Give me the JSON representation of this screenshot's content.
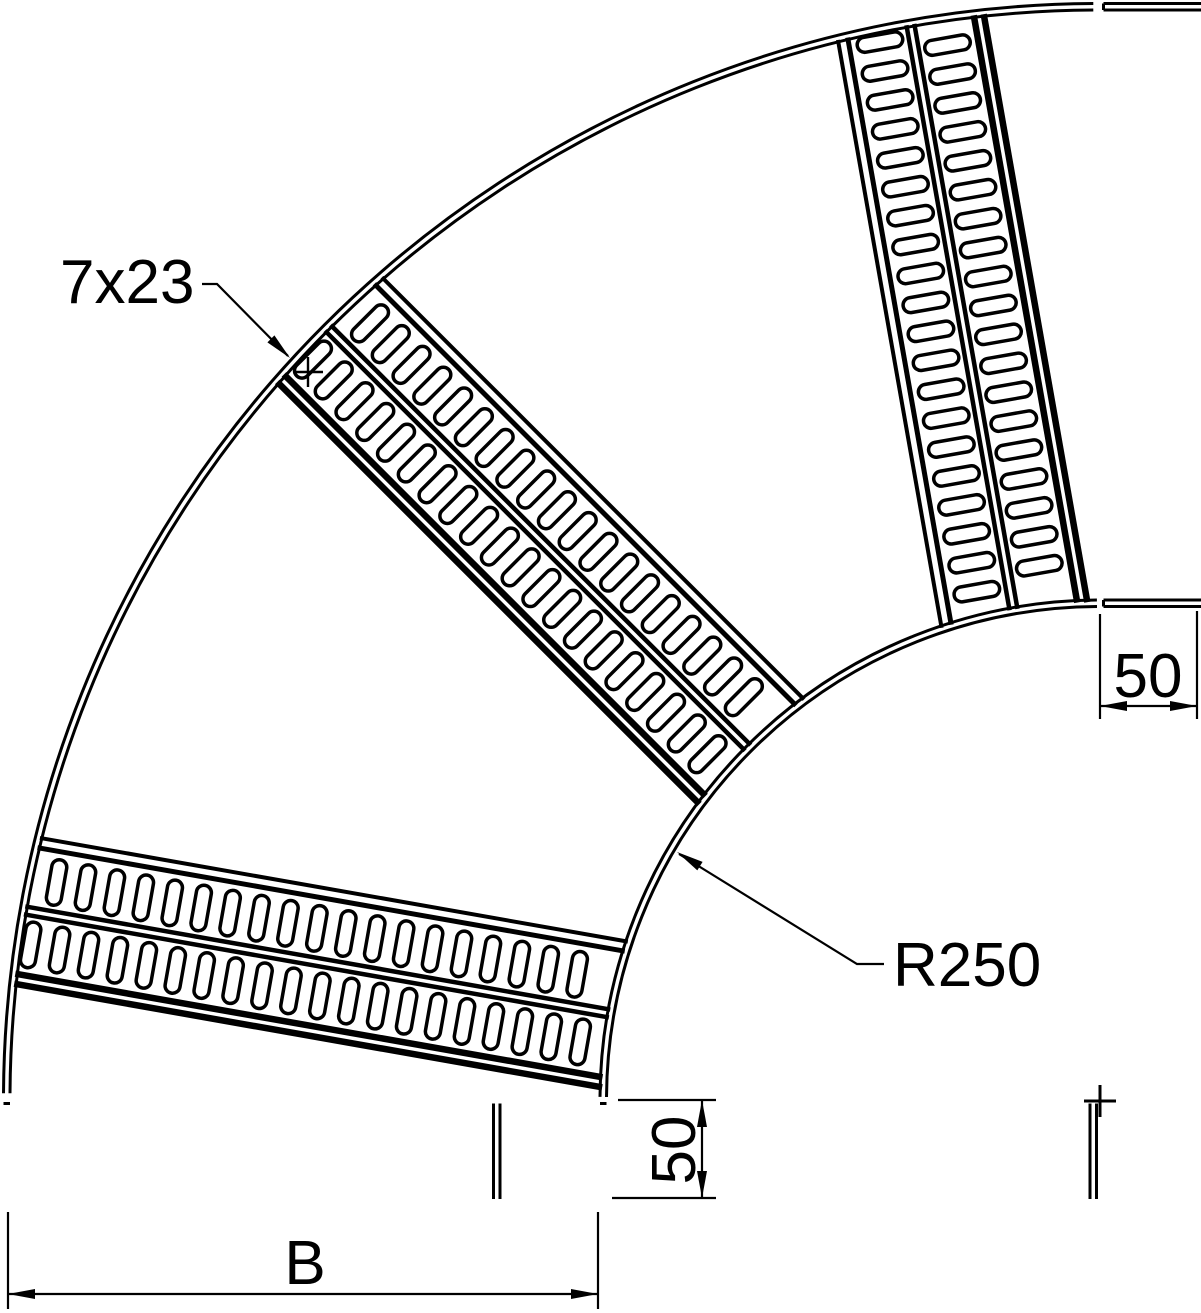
{
  "labels": {
    "slot_size": "7x23",
    "bend_radius": "R250",
    "top_tangent_length": "50",
    "bottom_tangent_length": "50",
    "ladder_width": "B"
  },
  "colors": {
    "background": "#ffffff",
    "line": "#000000"
  },
  "geometry": {
    "canvas": {
      "width": 1201,
      "height": 1313
    },
    "center": {
      "x": 1100,
      "y": 1100
    },
    "scale_px_per_mm": 2,
    "inner_radius_px": 500,
    "outer_radius_px": 1090,
    "rail_face_gap_px": 6.5,
    "tangent_end_px": 98,
    "arc_span_deg": [
      180.35,
      269.65
    ],
    "rungs": [
      {
        "angle_deg": 190,
        "heavy_side": -1
      },
      {
        "angle_deg": 225,
        "heavy_side": -1
      },
      {
        "angle_deg": 260,
        "heavy_side": 1
      }
    ],
    "rung_profile": {
      "edge_line_offsets": [
        64,
        74
      ],
      "mid_line_offset": 4,
      "slot_row_offset": 33,
      "slot": {
        "width": 15,
        "length": 46,
        "corner_radius": 7.5,
        "pitch": 29.37,
        "first_center_r": 522,
        "count_per_row": 20
      }
    }
  }
}
